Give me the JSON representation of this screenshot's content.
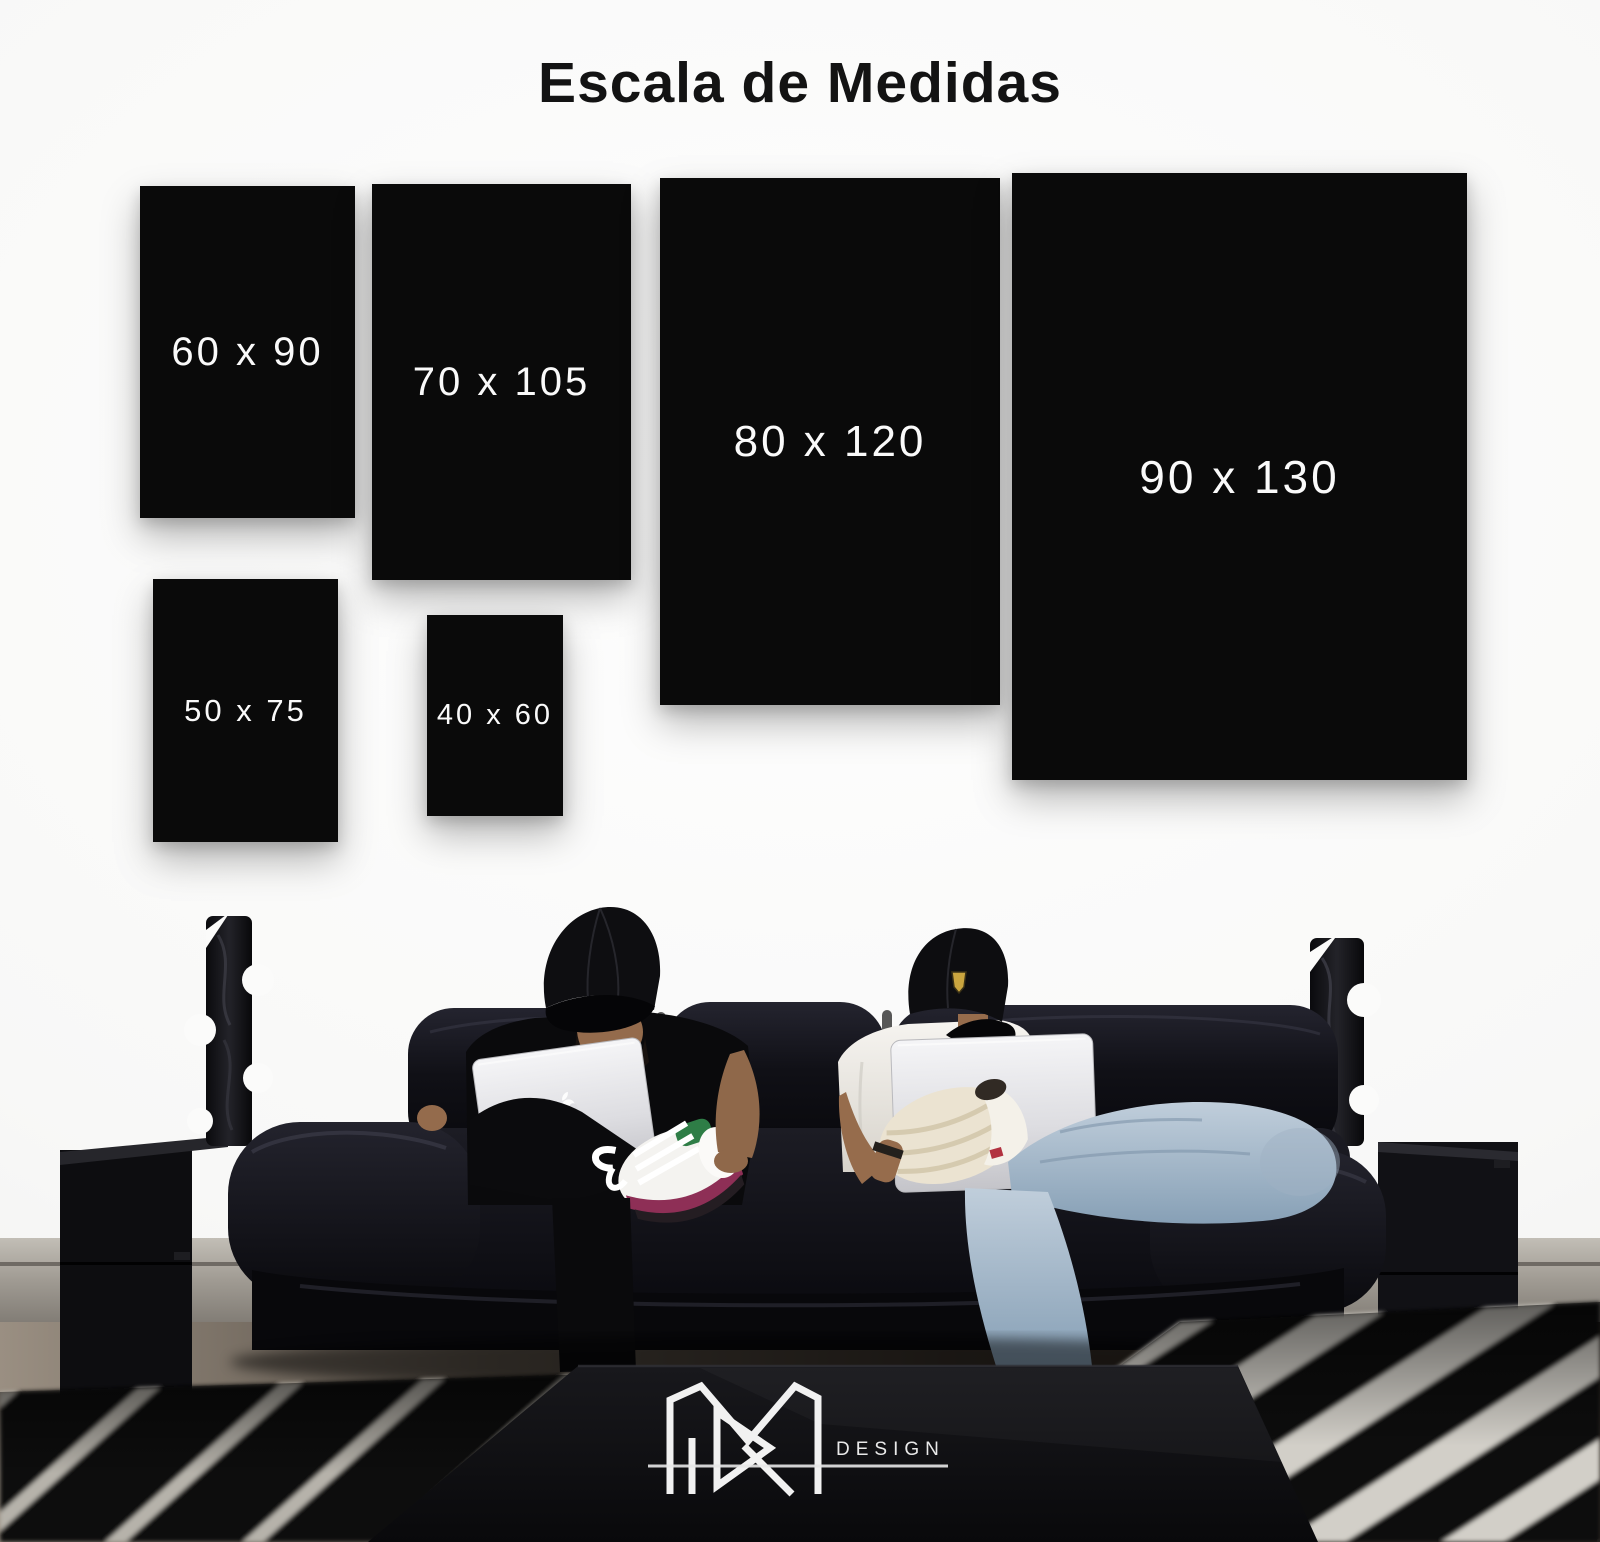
{
  "title": "Escala de Medidas",
  "sizes": [
    {
      "id": "60x90",
      "label": "60 x 90"
    },
    {
      "id": "70x105",
      "label": "70 x 105"
    },
    {
      "id": "80x120",
      "label": "80 x 120"
    },
    {
      "id": "90x130",
      "label": "90 x 130"
    },
    {
      "id": "50x75",
      "label": "50 x 75"
    },
    {
      "id": "40x60",
      "label": "40 x 60"
    }
  ],
  "brand": {
    "wordmark": "DESIGN"
  },
  "colors": {
    "poster_swatch": "#0a0a0a",
    "wall": "#f8f8f7",
    "size_label_text": "#fafafa",
    "title_text": "#131313",
    "logo_white": "#efefef"
  }
}
